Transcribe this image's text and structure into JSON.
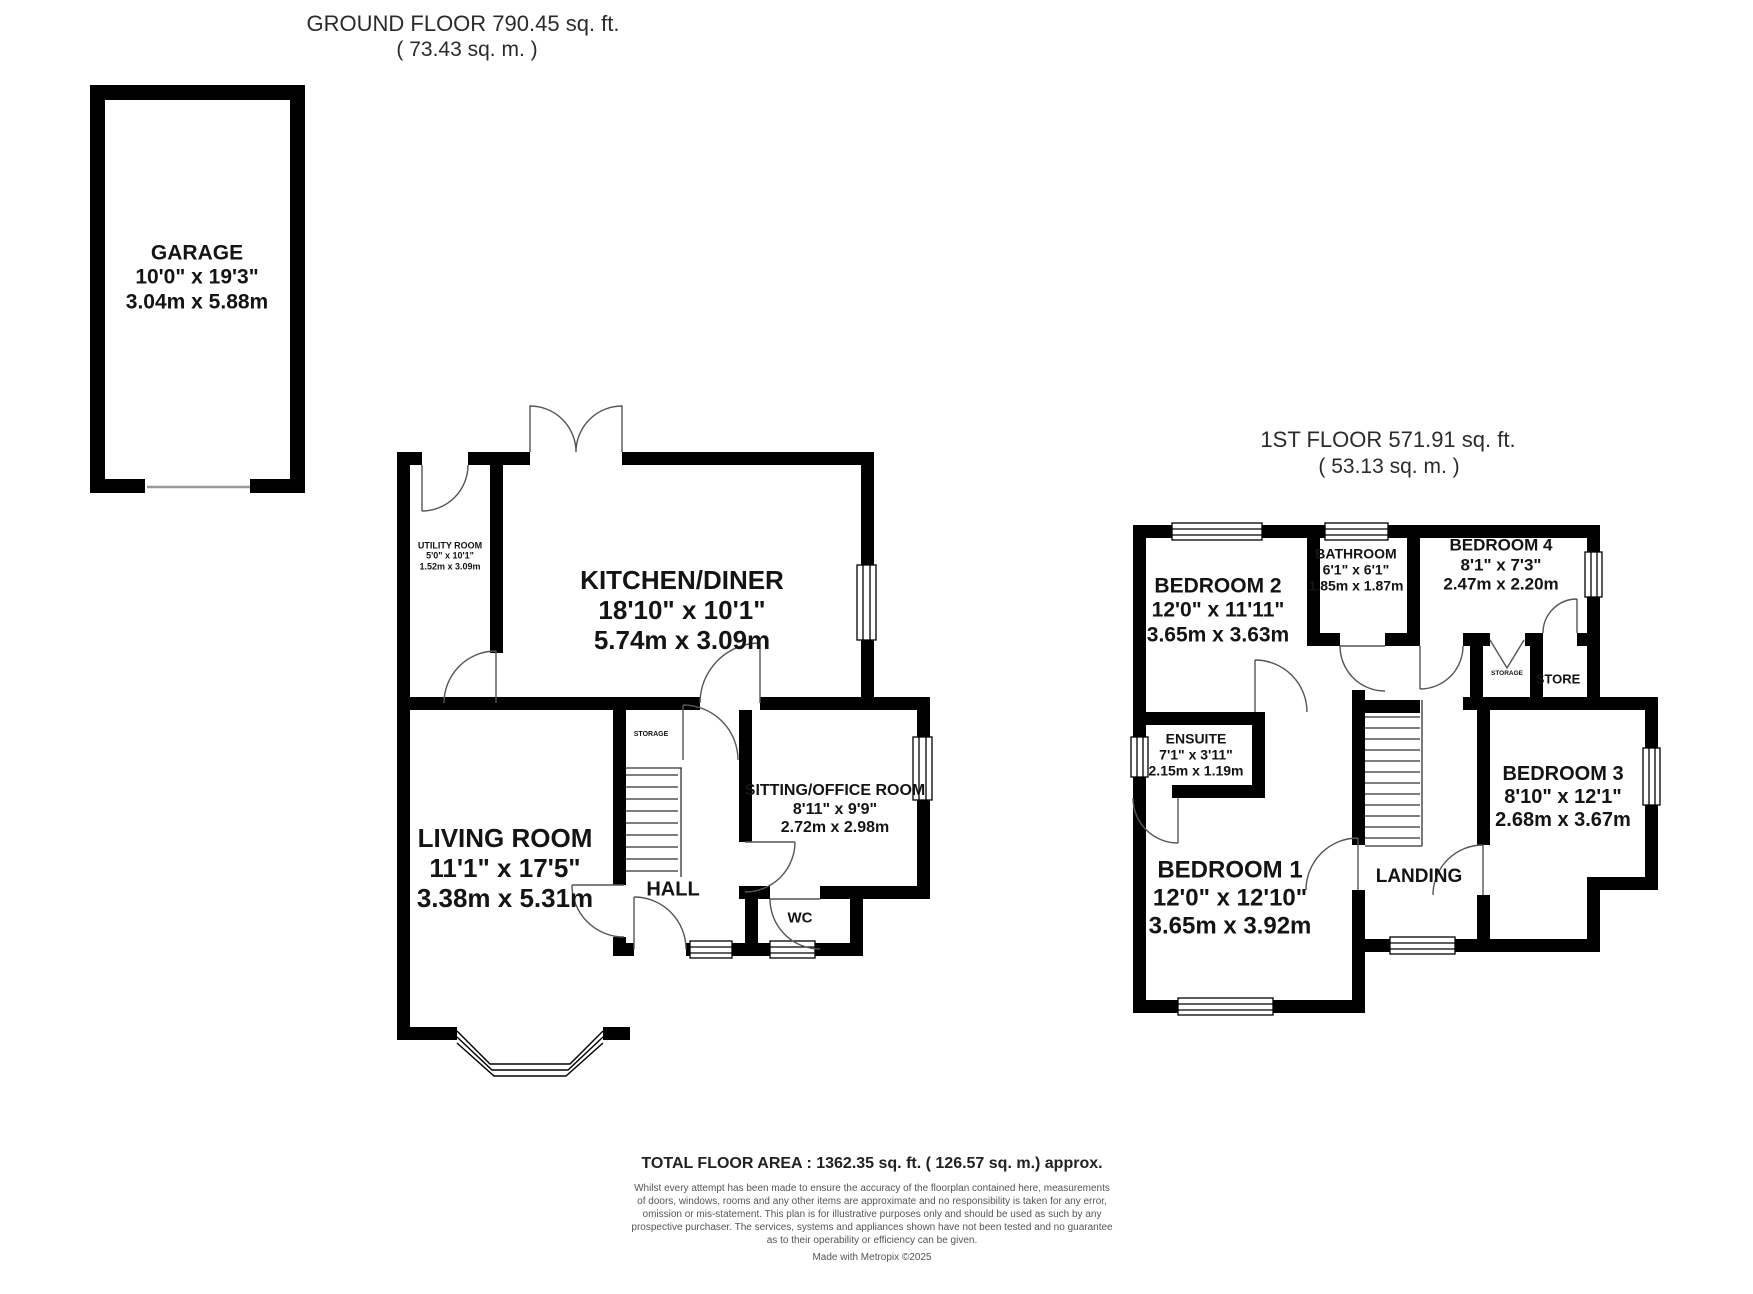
{
  "ground_floor": {
    "title": "GROUND FLOOR 790.45 sq. ft.",
    "subtitle": "( 73.43 sq. m. )",
    "rooms": {
      "garage": {
        "name": "GARAGE",
        "imperial": "10'0\" x 19'3\"",
        "metric": "3.04m x 5.88m"
      },
      "utility": {
        "name": "UTILITY ROOM",
        "imperial": "5'0\" x 10'1\"",
        "metric": "1.52m x 3.09m"
      },
      "kitchen": {
        "name": "KITCHEN/DINER",
        "imperial": "18'10\" x 10'1\"",
        "metric": "5.74m x 3.09m"
      },
      "living": {
        "name": "LIVING ROOM",
        "imperial": "11'1\" x 17'5\"",
        "metric": "3.38m x 5.31m"
      },
      "sitting": {
        "name": "SITTING/OFFICE ROOM",
        "imperial": "8'11\" x 9'9\"",
        "metric": "2.72m x 2.98m"
      },
      "hall": {
        "name": "HALL"
      },
      "wc": {
        "name": "WC"
      },
      "storage": {
        "name": "STORAGE"
      }
    }
  },
  "first_floor": {
    "title": "1ST FLOOR 571.91 sq. ft.",
    "subtitle": "( 53.13 sq. m. )",
    "rooms": {
      "bedroom1": {
        "name": "BEDROOM 1",
        "imperial": "12'0\" x 12'10\"",
        "metric": "3.65m x 3.92m"
      },
      "bedroom2": {
        "name": "BEDROOM 2",
        "imperial": "12'0\" x 11'11\"",
        "metric": "3.65m x 3.63m"
      },
      "bedroom3": {
        "name": "BEDROOM 3",
        "imperial": "8'10\" x 12'1\"",
        "metric": "2.68m x 3.67m"
      },
      "bedroom4": {
        "name": "BEDROOM 4",
        "imperial": "8'1\" x 7'3\"",
        "metric": "2.47m x 2.20m"
      },
      "bathroom": {
        "name": "BATHROOM",
        "imperial": "6'1\" x 6'1\"",
        "metric": "1.85m x 1.87m"
      },
      "ensuite": {
        "name": "ENSUITE",
        "imperial": "7'1\" x 3'11\"",
        "metric": "2.15m x 1.19m"
      },
      "landing": {
        "name": "LANDING"
      },
      "storage": {
        "name": "STORAGE"
      },
      "store": {
        "name": "STORE"
      }
    }
  },
  "footer": {
    "total_area": "TOTAL FLOOR AREA : 1362.35 sq. ft. ( 126.57 sq. m.) approx.",
    "disclaimer_lines": [
      "Whilst every attempt has been made to ensure the accuracy of the floorplan contained here, measurements",
      "of doors, windows, rooms and any other items are approximate and no responsibility is taken for any error,",
      "omission or mis-statement. This plan is for illustrative purposes only and should be used as such by any",
      "prospective purchaser. The services, systems and appliances shown have not been tested and no guarantee",
      "as to their operability or efficiency can be given."
    ],
    "credit": "Made with Metropix ©2025"
  }
}
